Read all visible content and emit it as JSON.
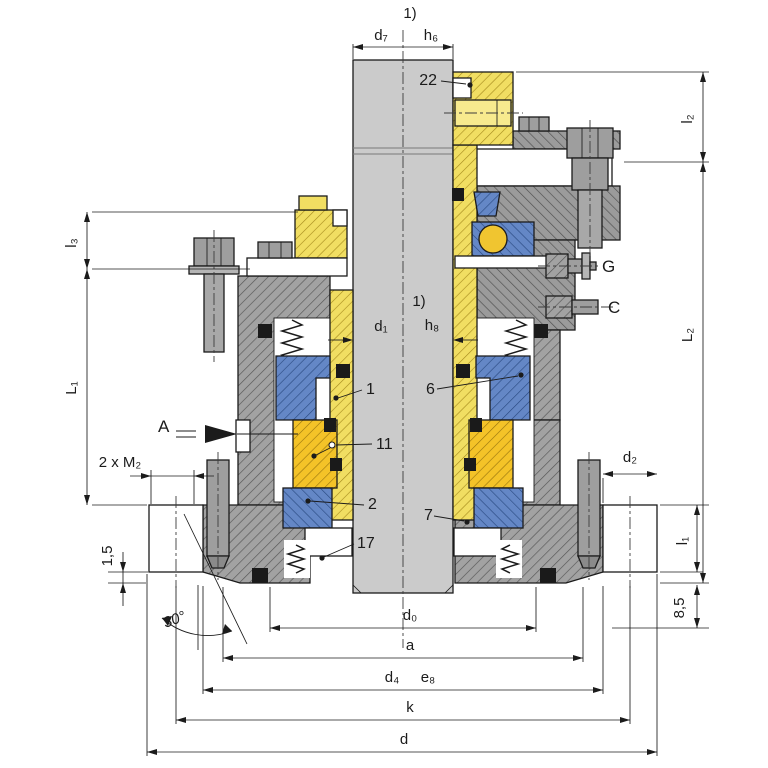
{
  "drawing": {
    "type": "mechanical-seal-cross-section",
    "colors": {
      "housing_gray": "#a2a2a2",
      "shaft_gray": "#cbcbcb",
      "sleeve_yellow": "#f1de62",
      "seat_gold": "#f4c328",
      "seal_blue": "#6487c6",
      "oring_black": "#1a1a1a",
      "line": "#1b1b1b",
      "background": "#ffffff"
    }
  },
  "dims": {
    "top": {
      "note": "1)",
      "d7": "d₇",
      "h6": "h₆"
    },
    "mid": {
      "note": "1)",
      "d1": "d₁",
      "h8": "h₈"
    },
    "left": {
      "l3": "l₃",
      "L1": "L₁",
      "m2": "2 x M₂",
      "step": "1,5",
      "angle": "30°"
    },
    "right": {
      "l2": "l₂",
      "L2": "L₂",
      "l1": "l₁",
      "d2": "d₂",
      "offset": "8,5"
    },
    "bottom": {
      "d0": "d₀",
      "a": "a",
      "d4": "d₄",
      "e8": "e₈",
      "k": "k",
      "d": "d"
    }
  },
  "parts": {
    "p1": "1",
    "p2": "2",
    "p6": "6",
    "p7": "7",
    "p11": "11",
    "p17": "17",
    "p22": "22"
  },
  "markers": {
    "view_a": "A",
    "port_g": "G",
    "port_c": "C"
  }
}
